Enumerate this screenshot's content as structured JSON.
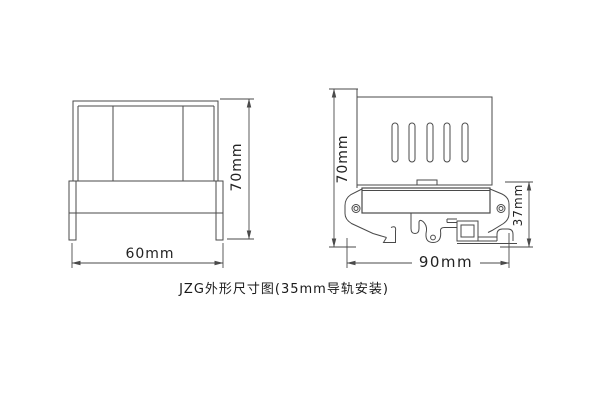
{
  "caption": "JZG外形尺寸图(35mm导轨安装)",
  "front_view": {
    "width_label": "60mm",
    "height_label": "70mm"
  },
  "side_view": {
    "height_label": "70mm",
    "width_label": "90mm",
    "base_height_label": "37mm"
  },
  "colors": {
    "line": "#4a4a4a",
    "text": "#222222",
    "background": "#ffffff"
  }
}
